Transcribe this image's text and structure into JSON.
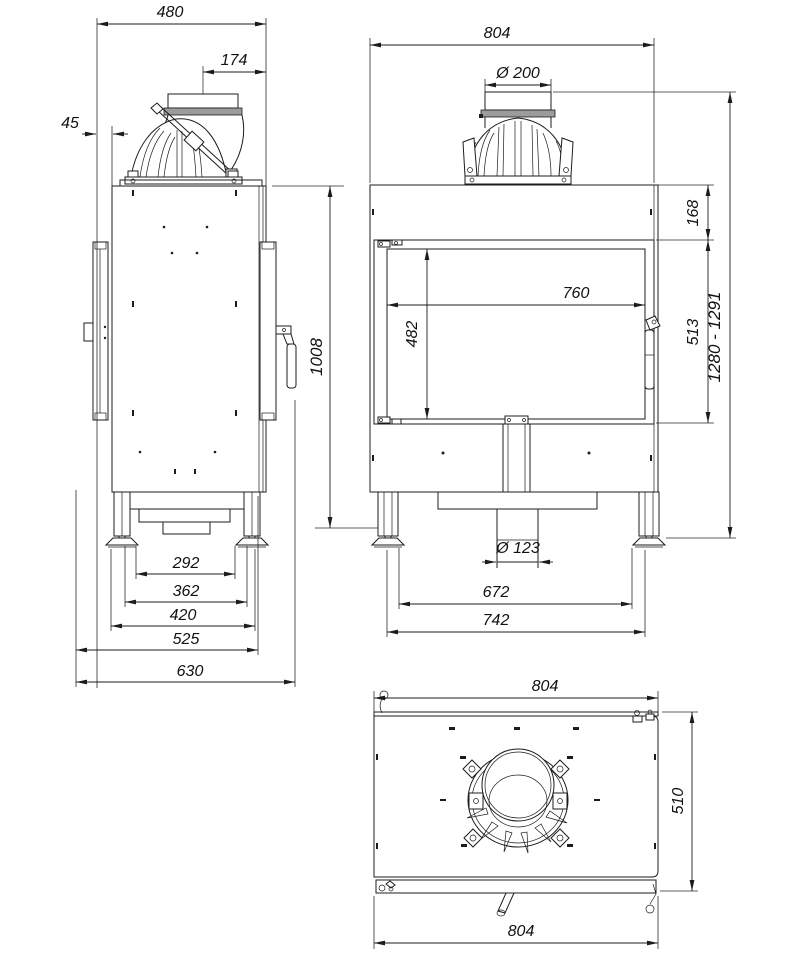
{
  "drawing": {
    "background_color": "#ffffff",
    "line_color": "#1c1c1c",
    "side_view": {
      "overall_depth": "480",
      "flue_center_to_front": "174",
      "rear_clearance": "45",
      "body_height": "1008",
      "feet_spacing_inner": "292",
      "feet_spacing_center": "362",
      "feet_spacing_outer": "420",
      "base_depth": "525",
      "max_depth": "630"
    },
    "front_view": {
      "overall_width": "804",
      "flue_diameter": "Ø 200",
      "overall_height_range": "1280 - 1291",
      "top_to_door": "168",
      "door_height": "513",
      "glass_width": "760",
      "glass_height": "482",
      "air_inlet_diameter": "Ø 123",
      "feet_spacing_inner": "672",
      "feet_spacing_outer": "742"
    },
    "top_view": {
      "overall_width": "804",
      "overall_depth": "510",
      "front_width": "804"
    }
  }
}
